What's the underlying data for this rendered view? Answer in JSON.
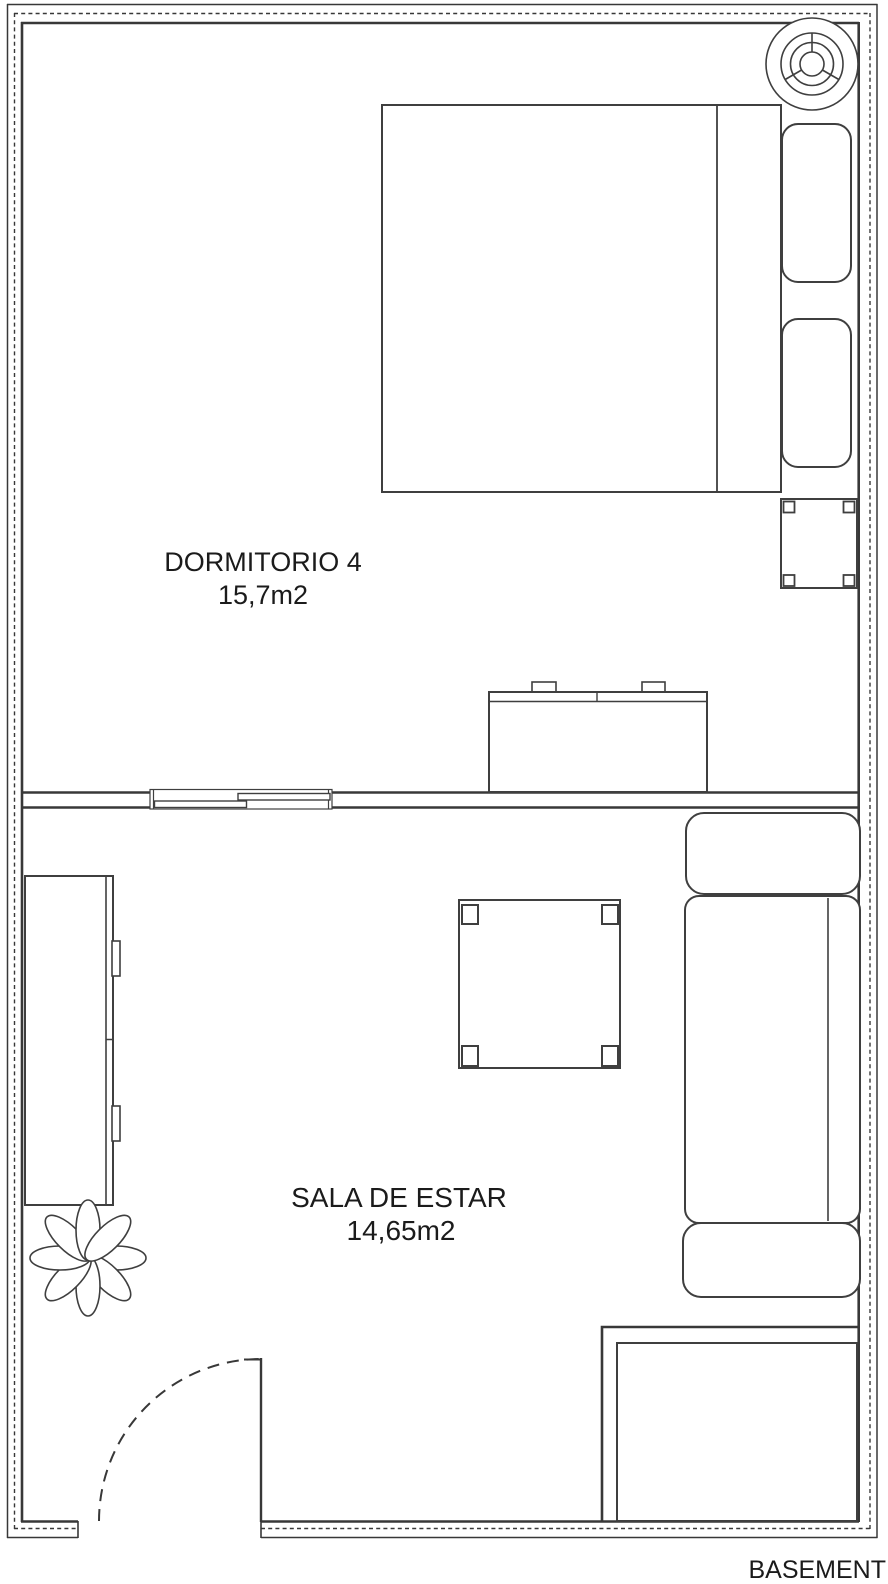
{
  "floorplan": {
    "rooms": [
      {
        "name": "DORMITORIO 4",
        "area": "15,7m2"
      },
      {
        "name": "SALA DE ESTAR",
        "area": "14,65m2"
      }
    ],
    "basement_label": "BASEMENT",
    "colors": {
      "background": "#ffffff",
      "wall": "#383838",
      "furniture": "#3f3f3f",
      "text": "#1b1b1b"
    },
    "furniture_icons": [
      "ceiling-fan-icon",
      "double-bed-icon",
      "pillow-icon",
      "nightstand-icon",
      "dresser-icon",
      "sliding-window-icon",
      "sideboard-icon",
      "plant-icon",
      "coffee-table-icon",
      "sofa-icon",
      "door-swing-icon",
      "basement-stairs-icon"
    ]
  }
}
